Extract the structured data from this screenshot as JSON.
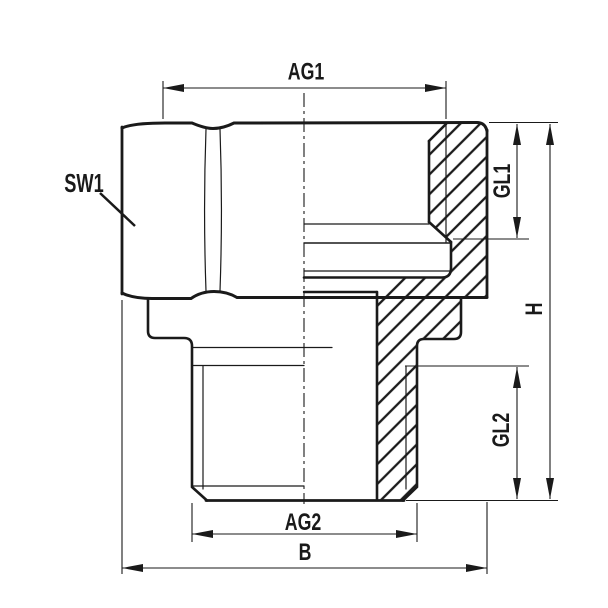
{
  "drawing": {
    "kind": "technical-drawing-half-section",
    "colors": {
      "line": "#1a1a1a",
      "background": "#ffffff"
    },
    "labels": {
      "ag1": "AG1",
      "sw1": "SW1",
      "gl1": "GL1",
      "h": "H",
      "gl2": "GL2",
      "ag2": "AG2",
      "b": "B"
    },
    "dimensions": [
      {
        "label": "AG1",
        "orientation": "horizontal",
        "position": "top"
      },
      {
        "label": "SW1",
        "orientation": "leader",
        "position": "left"
      },
      {
        "label": "GL1",
        "orientation": "vertical",
        "position": "right-inner-upper"
      },
      {
        "label": "H",
        "orientation": "vertical",
        "position": "right-outer"
      },
      {
        "label": "GL2",
        "orientation": "vertical",
        "position": "right-inner-lower"
      },
      {
        "label": "AG2",
        "orientation": "horizontal",
        "position": "bottom-upper"
      },
      {
        "label": "B",
        "orientation": "horizontal",
        "position": "bottom-lower"
      }
    ]
  }
}
